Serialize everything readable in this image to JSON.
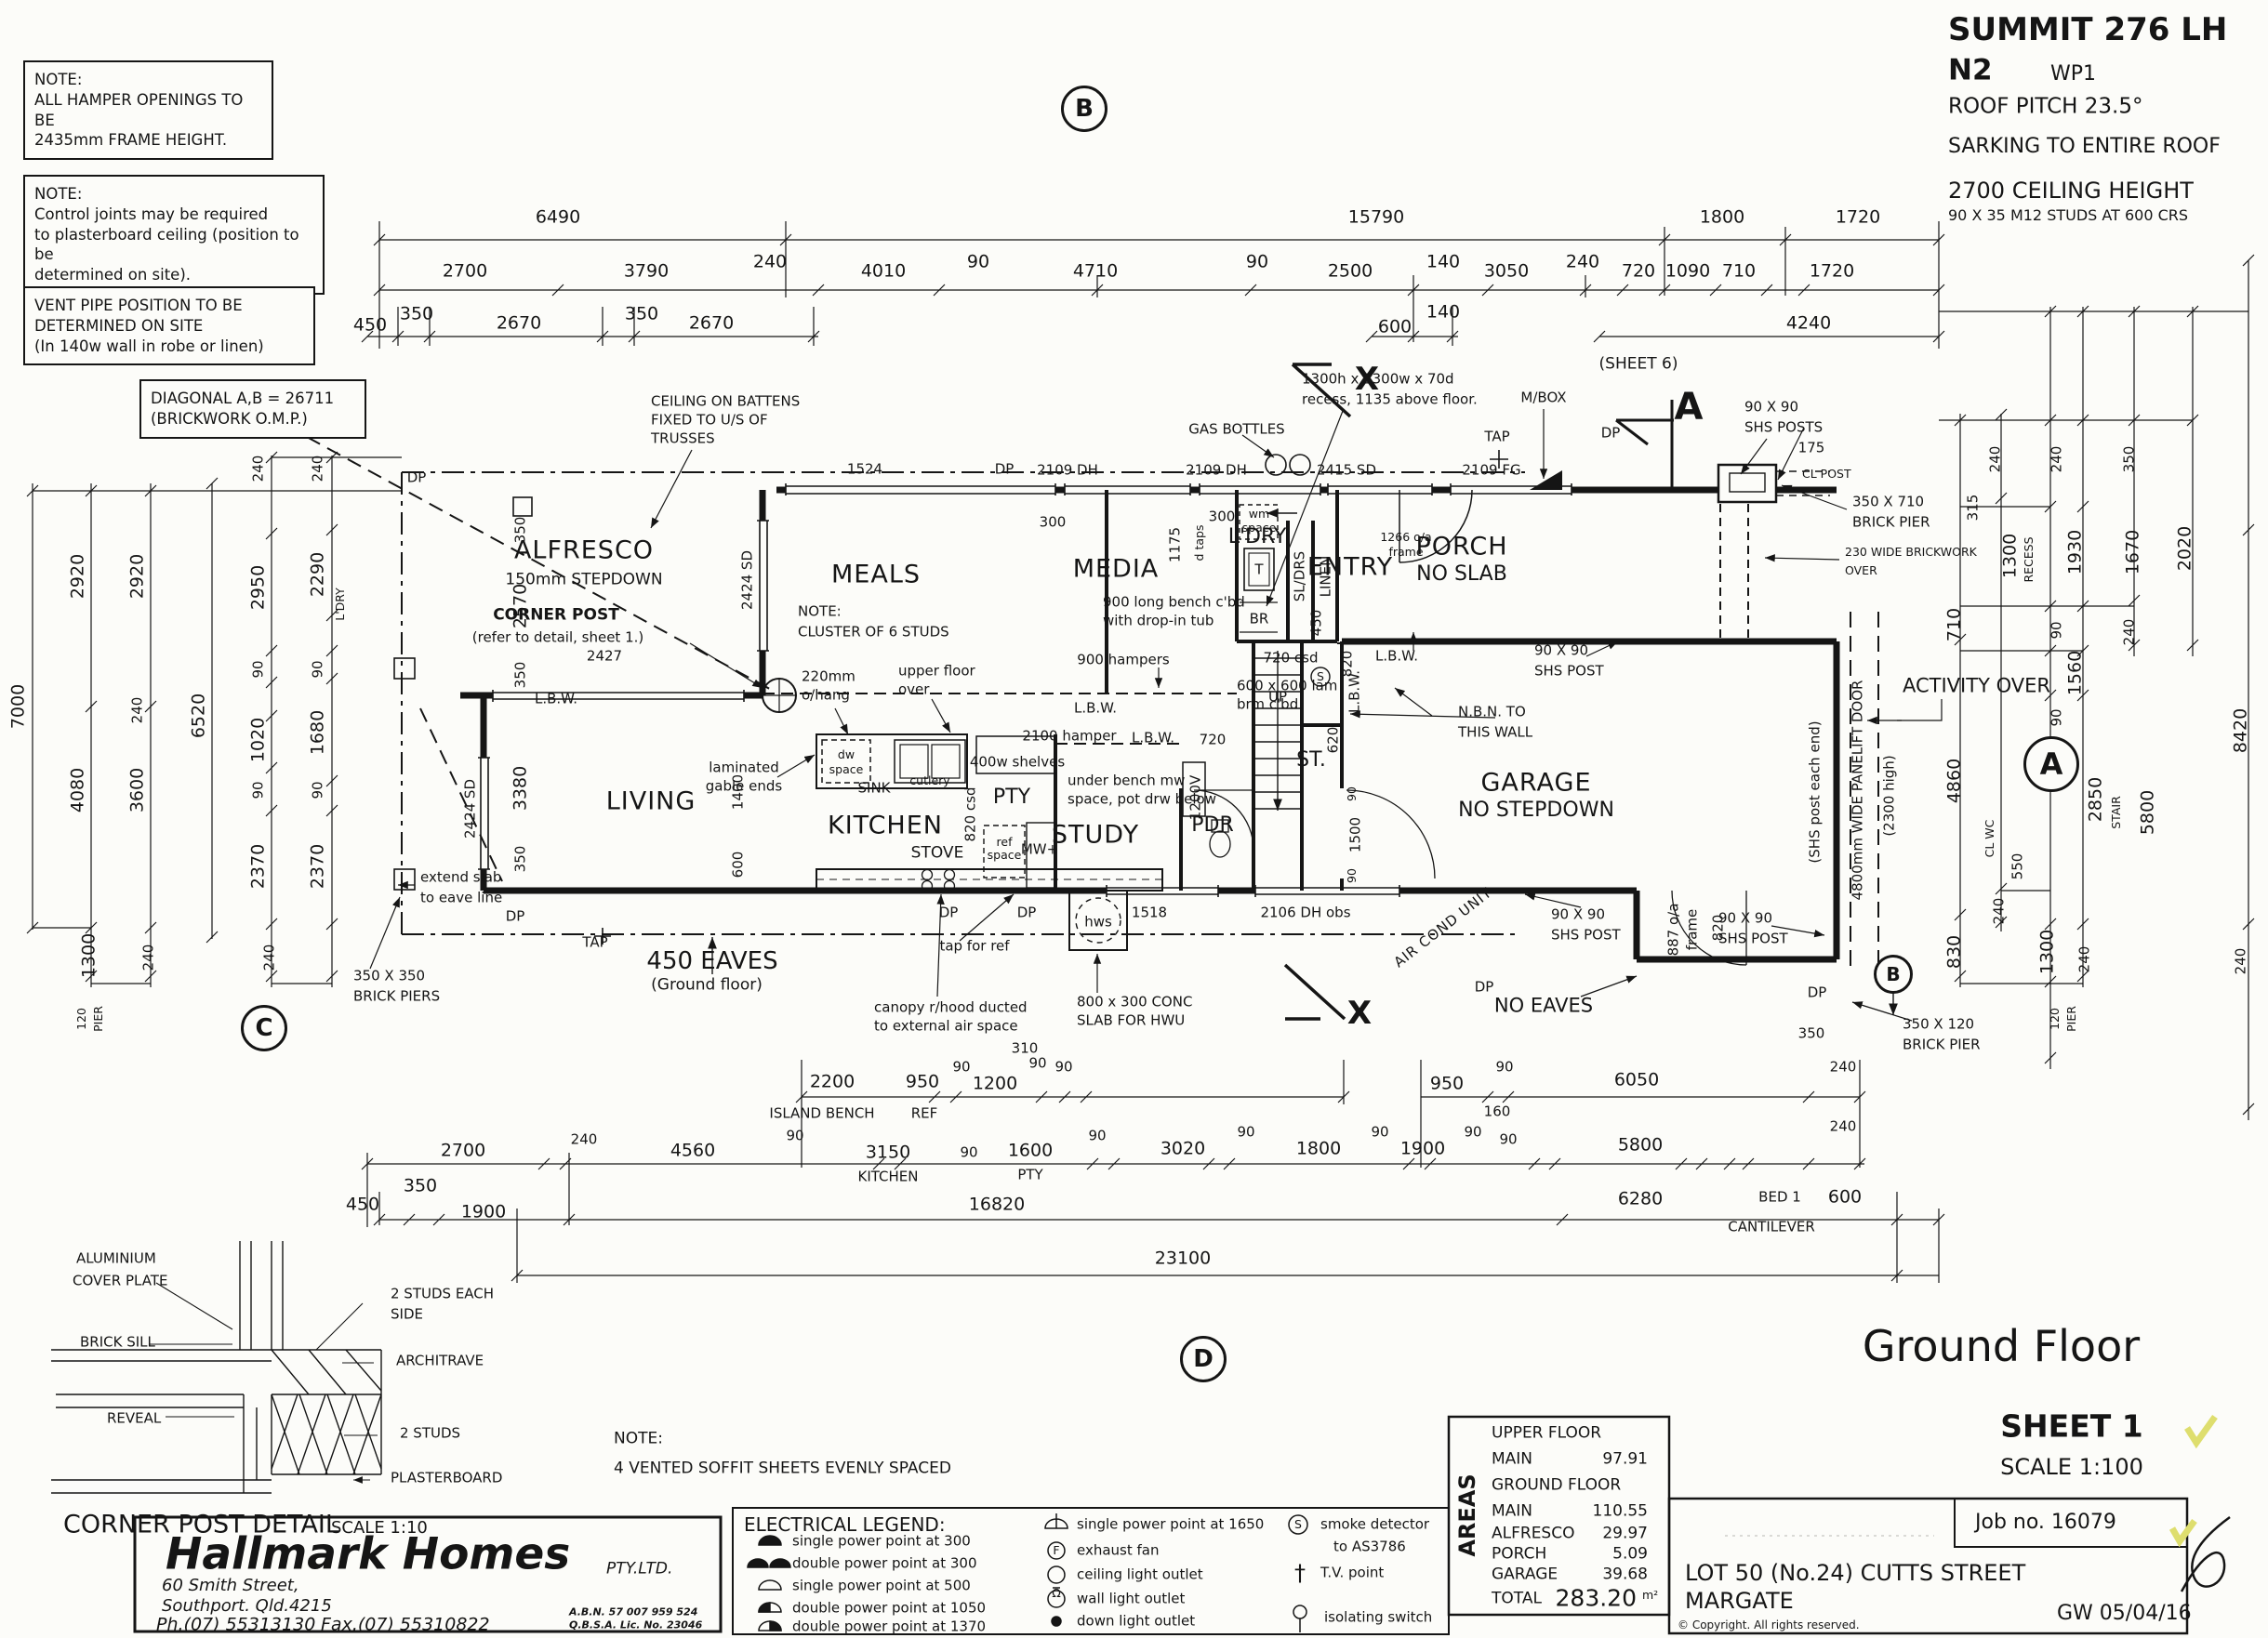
{
  "c": {
    "dp": "DP",
    "tap": "TAP",
    "lbw": "L.B.W.",
    "n90": "90",
    "n240": "240",
    "n350": "350",
    "n2670": "2670",
    "n2920": "2920",
    "n2370": "2370",
    "n1720": "1720",
    "n1300": "1300",
    "n600": "600",
    "n720": "720",
    "n820": "820",
    "n120": "120",
    "pier": "PIER",
    "n2424sd": "2424 SD",
    "n2109dh": "2109 DH",
    "n9090": "90 X 90",
    "shspost": "SHS POST",
    "n300": "300"
  },
  "t": {
    "model": "SUMMIT 276 LH",
    "wind": "N2",
    "wp": "WP1",
    "pitch": "ROOF PITCH 23.5°",
    "sark": "SARKING TO ENTIRE ROOF",
    "ceil": "2700 CEILING HEIGHT",
    "studs": "90 X 35 M12 STUDS AT 600 CRS"
  },
  "n": {
    "note": "NOTE:",
    "h1": "ALL HAMPER OPENINGS TO BE",
    "h2": "2435mm FRAME HEIGHT.",
    "c1": "Control joints may be required",
    "c2": "to plasterboard ceiling (position to be",
    "c3": "determined on site).",
    "v1": "VENT PIPE POSITION TO BE",
    "v2": "DETERMINED ON SITE",
    "v3": "(In 140w wall in robe or linen)",
    "d1": "DIAGONAL A,B = 26711",
    "d2": "(BRICKWORK O.M.P.)"
  },
  "mk": {
    "a": "A",
    "b": "B",
    "c": "C",
    "d": "D",
    "x": "X",
    "sheet6": "(SHEET 6)"
  },
  "dims": {
    "t1": [
      "6490",
      "15790",
      "1800",
      "1720"
    ],
    "t2": [
      "2700",
      "3790",
      "240",
      "4010",
      "90",
      "4710",
      "90",
      "2500",
      "140",
      "3050",
      "240",
      "720",
      "1090",
      "710",
      "1720"
    ],
    "t3": [
      "450",
      "350",
      "2670",
      "350",
      "2670",
      "600",
      "140",
      "4240"
    ],
    "bA": [
      "2200",
      "950",
      "90",
      "1200",
      "90",
      "310",
      "90",
      "950",
      "90",
      "6050",
      "240"
    ],
    "bAl": [
      "ISLAND BENCH",
      "REF"
    ],
    "bB": [
      "2700",
      "240",
      "4560",
      "90",
      "3150",
      "90",
      "1600",
      "90",
      "3020",
      "90",
      "1800",
      "90",
      "1900",
      "90",
      "160",
      "90",
      "5800",
      "240"
    ],
    "bBl": [
      "KITCHEN",
      "PTY"
    ],
    "bC": [
      "450",
      "350",
      "1900",
      "16820",
      "6280",
      "BED 1",
      "600",
      "CANTILEVER"
    ],
    "bD": "23100",
    "lft": [
      "7000",
      "2920",
      "4080",
      "2920",
      "240",
      "3600",
      "6520",
      "240",
      "2950",
      "90",
      "1020",
      "90",
      "2370",
      "240",
      "2290",
      "L'DRY",
      "90",
      "1680",
      "90",
      "2370",
      "1300",
      "240",
      "240",
      "120",
      "PIER"
    ],
    "rgt": [
      "240",
      "315",
      "1300",
      "RECESS",
      "710",
      "240",
      "1930",
      "90",
      "1560",
      "90",
      "350",
      "1670",
      "240",
      "2020",
      "8420",
      "4860",
      "830",
      "550",
      "240",
      "CL WC",
      "2850",
      "STAIR",
      "5800",
      "1300",
      "240",
      "120",
      "PIER",
      "240"
    ]
  },
  "pl": {
    "alf": "ALFRESCO",
    "alf2": "150mm STEPDOWN",
    "cp1": "CORNER POST",
    "cp2": "(refer to detail, sheet 1.)",
    "w2427": "2427",
    "meals": "MEALS",
    "cl1": "CLUSTER OF 6 STUDS",
    "oh1": "220mm",
    "oh2": "o/hang",
    "uf1": "upper floor",
    "uf2": "over",
    "w1524": "1524",
    "w2415": "2415 SD",
    "w2109fg": "2109 FG",
    "n1175": "1175",
    "dtaps": "d taps",
    "media": "MEDIA",
    "bench1": "900 long bench c'bd",
    "bench2": "with drop-in tub",
    "hampers": "900 hampers",
    "hamper2": "2100 hamper",
    "ldry": "L'DRY",
    "wm1": "wm",
    "wm2": "space",
    "tub": "T",
    "br": "BR",
    "sldrs": "SL/DRS",
    "linen": "LINEN",
    "entry": "ENTRY",
    "fr1": "1266 o/a",
    "fr2": "frame",
    "porch": "PORCH",
    "porch2": "NO SLAB",
    "csd720": "720 csd",
    "lam1": "600 x 600 lam",
    "lam2": "brm c'bd",
    "n450": "450",
    "s": "S",
    "up": "UP",
    "liv": "LIVING",
    "kit": "KITCHEN",
    "stove": "STOVE",
    "sink": "SINK",
    "cut": "cutlery",
    "dw1": "dw",
    "dw2": "space",
    "gab1": "laminated",
    "gab2": "gable ends",
    "shelves": "400w shelves",
    "pty": "PTY",
    "csd820": "820 csd",
    "ref1": "ref",
    "ref2": "space",
    "mw": "MW+",
    "study": "STUDY",
    "ub1": "under bench mw",
    "ub2": "space, pot drw below",
    "pdr": "PDR",
    "van": "1200V",
    "st": "ST.",
    "n620": "620",
    "gar": "GARAGE",
    "gar2": "NO STEPDOWN",
    "n1500": "1500",
    "nbn1": "N.B.N. TO",
    "nbn2": "THIS WALL",
    "shse": "(SHS post each end)",
    "plift": "4800mm WIDE PANELIFT DOOR",
    "plift2": "(2300 high)",
    "act": "ACTIVITY OVER",
    "gas": "GAS BOTTLES",
    "mbox": "M/BOX",
    "rec1": "1300h x 1300w x 70d",
    "rec2": "recess, 1135 above floor.",
    "shsposts": "SHS POSTS",
    "n175": "175",
    "clpost": "CL POST",
    "bp1": "350 X 710",
    "bp2": "BRICK PIER",
    "bw1": "230 WIDE BRICKWORK",
    "bw2": "OVER",
    "ceil1": "CEILING ON BATTENS",
    "ceil2": "FIXED TO U/S OF",
    "ceil3": "TRUSSES",
    "ext1": "extend slab",
    "ext2": "to eave line",
    "n2570": "2570",
    "n3380": "3380",
    "n1400": "1400",
    "eaves1": "450 EAVES",
    "eaves2": "(Ground floor)",
    "noeaves": "NO EAVES",
    "can1": "canopy r/hood ducted",
    "can2": "to external air space",
    "tapref": "tap for ref",
    "hws": "hws",
    "conc1": "800 x 300 CONC",
    "conc2": "SLAB FOR HWU",
    "w1518": "1518",
    "w2106": "2106 DH obs",
    "air": "AIR COND UNIT",
    "oaf1": "887 o/a",
    "oaf2": "frame",
    "bp3": "350 X 120",
    "piers1": "350 X 350",
    "piers2": "BRICK PIERS"
  },
  "cpd": {
    "l1": "ALUMINIUM",
    "l2": "COVER PLATE",
    "l3": "BRICK SILL",
    "l4": "REVEAL",
    "l5": "2 STUDS EACH",
    "l6": "SIDE",
    "l7": "ARCHITRAVE",
    "l8": "2 STUDS",
    "l9": "PLASTERBOARD",
    "t": "CORNER POST DETAIL",
    "sc": "SCALE 1:10"
  },
  "sof": {
    "n": "NOTE:",
    "t": "4 VENTED SOFFIT SHEETS EVENLY SPACED"
  },
  "hm": {
    "name": "Hallmark Homes",
    "pty": "PTY.LTD.",
    "a1": "60 Smith Street,",
    "a2": "Southport. Qld.4215",
    "ph": "Ph.(07) 55313130",
    "fax": "Fax.(07) 55310822",
    "abn": "A.B.N. 57 007 959 524",
    "lic": "Q.B.S.A. Lic. No. 23046"
  },
  "leg": {
    "title": "ELECTRICAL LEGEND:",
    "i1": [
      "single power point at 300",
      "double power point at 300",
      "single power point at 500",
      "double power point at 1050",
      "double power point at 1370"
    ],
    "i2": [
      "single power point at 1650",
      "exhaust fan",
      "ceiling light outlet",
      "wall light outlet",
      "down light outlet"
    ],
    "sd1": "smoke detector",
    "sd2": "to AS3786",
    "tv": "T.V. point",
    "iso": "isolating switch"
  },
  "sym": {
    "f": "F",
    "s": "S",
    "w": "Ω",
    "tv": "†"
  },
  "ar": {
    "side": "AREAS",
    "uf": "UPPER FLOOR",
    "gf": "GROUND FLOOR",
    "m1": "MAIN",
    "v1": "97.91",
    "m2": "MAIN",
    "v2": "110.55",
    "m3": "ALFRESCO",
    "v3": "29.97",
    "m4": "PORCH",
    "v4": "5.09",
    "m5": "GARAGE",
    "v5": "39.68",
    "tot": "TOTAL",
    "totv": "283.20",
    "unit": "m²"
  },
  "tbk": {
    "gf": "Ground Floor",
    "sheet": "SHEET 1",
    "scale": "SCALE 1:100",
    "job": "Job no. 16079",
    "lot": "LOT 50 (No.24) CUTTS STREET",
    "sub": "MARGATE",
    "date": "GW 05/04/16",
    "copy": "© Copyright. All rights reserved."
  }
}
